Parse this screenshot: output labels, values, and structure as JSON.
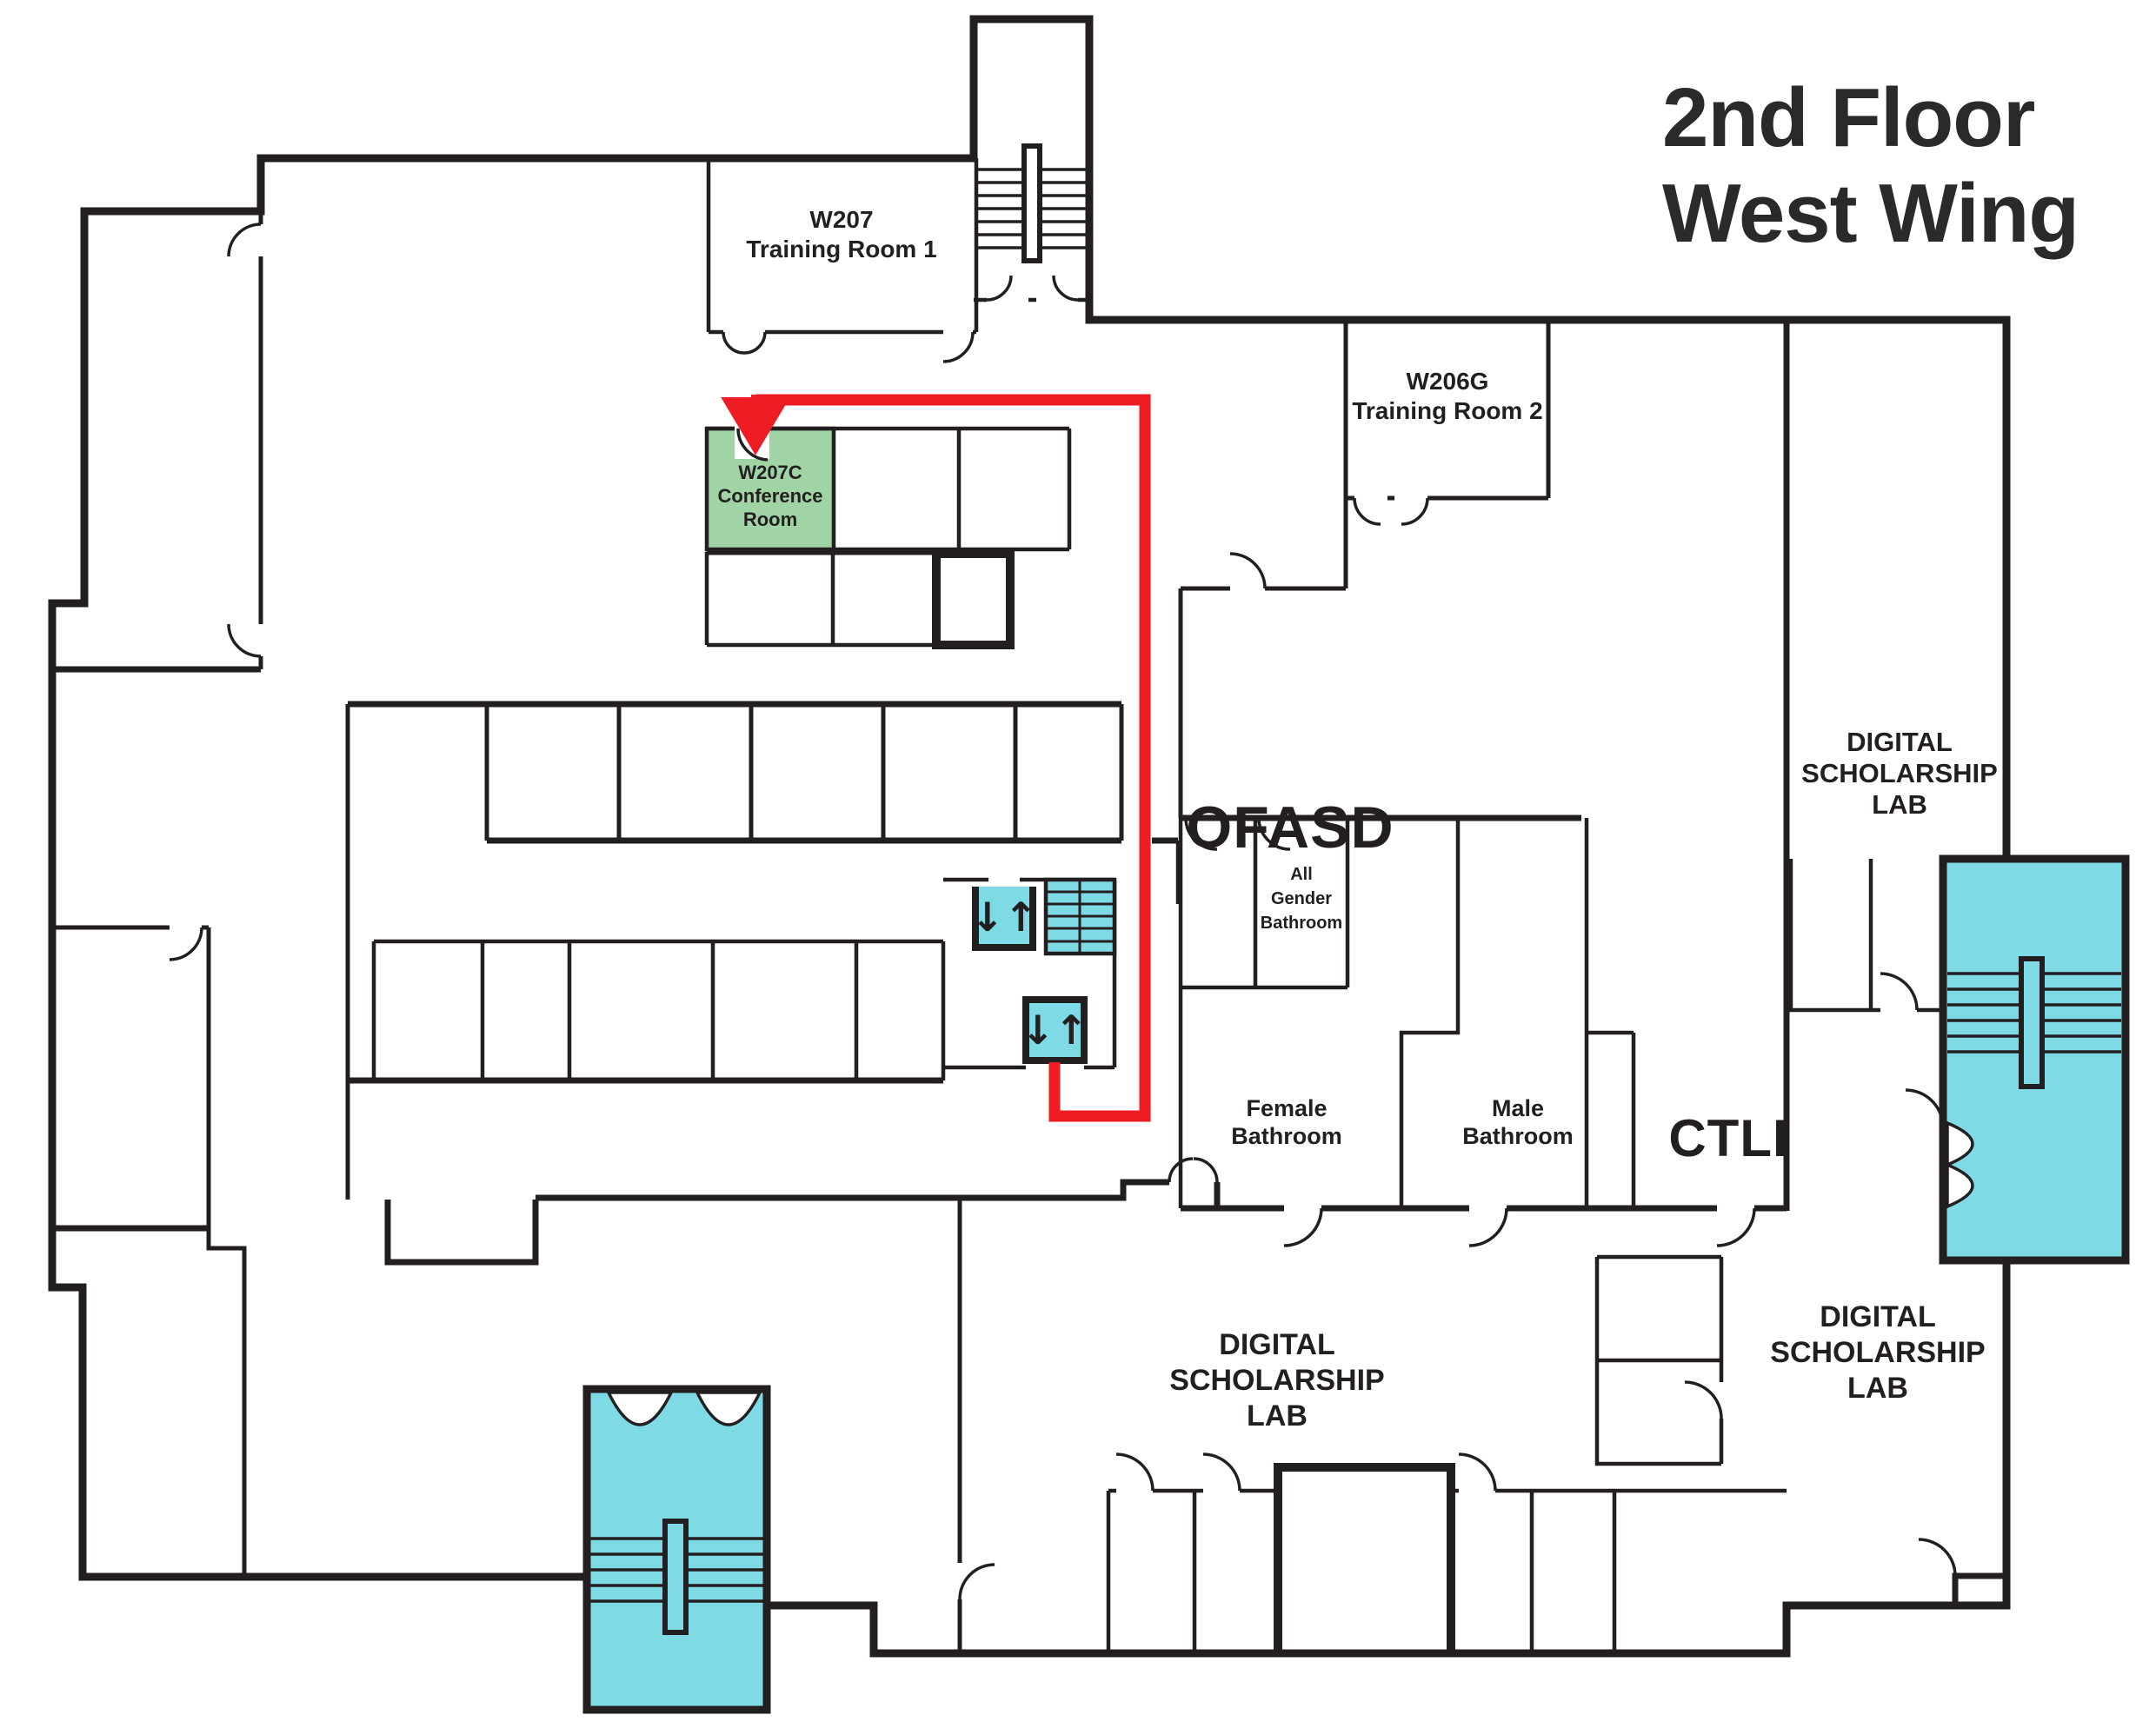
{
  "title": {
    "lines": [
      "2nd Floor",
      "West Wing"
    ]
  },
  "colors": {
    "wall": "#231f20",
    "highlight_room_green": "#a0d4a4",
    "stairs_elevators_teal": "#7edae4",
    "route_red": "#ee1c23",
    "background": "#ffffff"
  },
  "rooms": {
    "w207": [
      "W207",
      "Training Room 1"
    ],
    "w206g": [
      "W206G",
      "Training Room 2"
    ],
    "w207c": [
      "W207C",
      "Conference",
      "Room"
    ],
    "ofasd": "OFASD",
    "dsl_right": [
      "DIGITAL",
      "SCHOLARSHIP",
      "LAB"
    ],
    "all_gender": [
      "All",
      "Gender",
      "Bathroom"
    ],
    "female": [
      "Female",
      "Bathroom"
    ],
    "male": [
      "Male",
      "Bathroom"
    ],
    "ctli": "CTLI",
    "dsl_bottom_center": [
      "DIGITAL",
      "SCHOLARSHIP",
      "LAB"
    ],
    "dsl_bottom_right": [
      "DIGITAL",
      "SCHOLARSHIP",
      "LAB"
    ]
  },
  "icons": {
    "elevator_up_down": "↓↑"
  }
}
